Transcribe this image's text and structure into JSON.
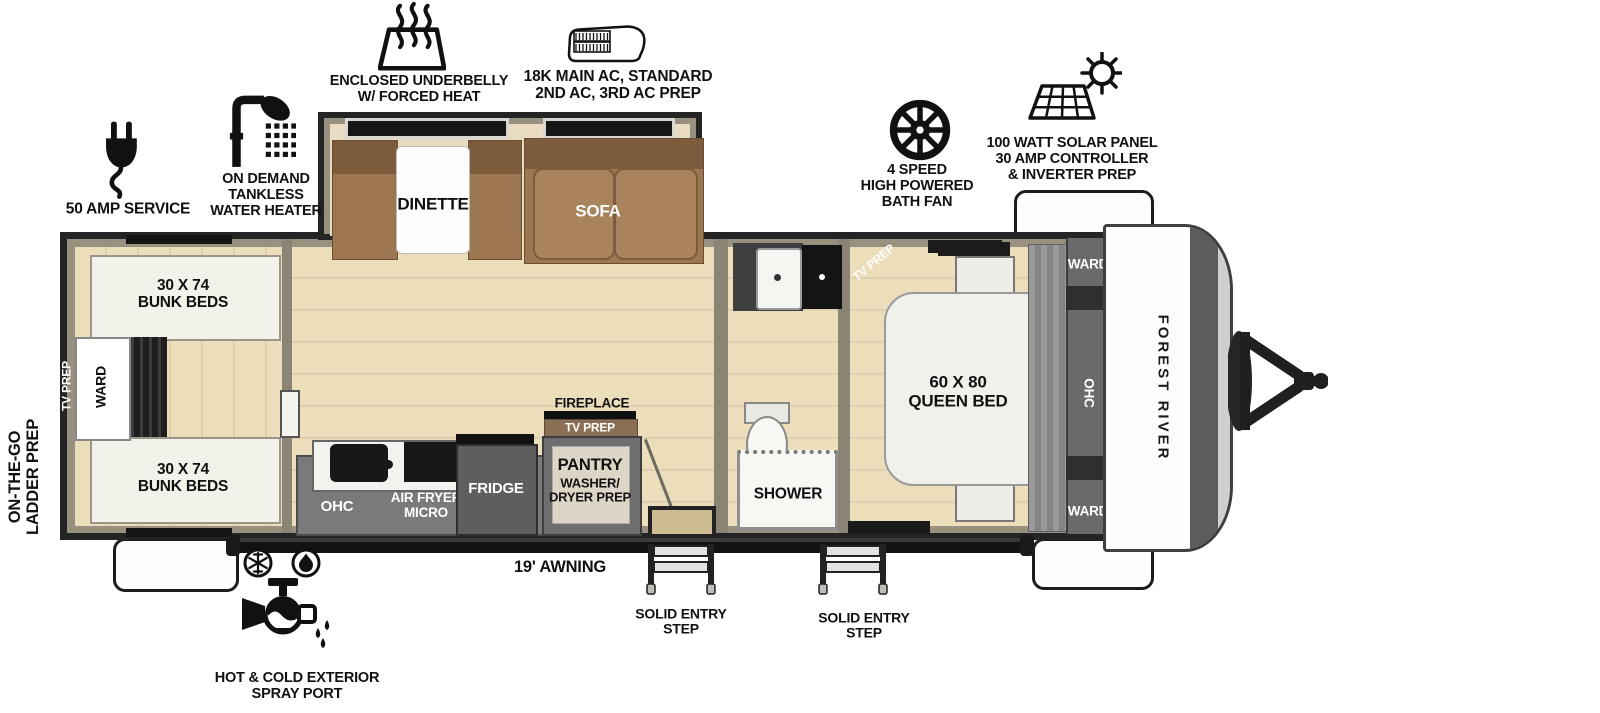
{
  "brand": "FOREST RIVER",
  "colors": {
    "outline": "#242424",
    "wall": "#99917f",
    "floor": "#ecddbb",
    "slide_floor": "#e9dcc2",
    "cabinet": "#7a7a7a",
    "sofa_brown": "#9c7751",
    "wood_trim": "#8a6f55"
  },
  "callouts": {
    "fifty_amp": "50 AMP SERVICE",
    "tankless": "ON DEMAND\nTANKLESS\nWATER HEATER",
    "underbelly": "ENCLOSED UNDERBELLY\nW/ FORCED HEAT",
    "main_ac": "18K MAIN AC, STANDARD\n2ND AC, 3RD AC PREP",
    "bath_fan": "4 SPEED\nHIGH POWERED\nBATH FAN",
    "solar": "100 WATT SOLAR PANEL\n30 AMP CONTROLLER\n& INVERTER PREP",
    "ladder_prep": "ON-THE-GO\nLADDER PREP",
    "awning": "19' AWNING",
    "entry_step_front": "SOLID ENTRY\nSTEP",
    "entry_step_rear": "SOLID ENTRY\nSTEP",
    "spray_port": "HOT & COLD EXTERIOR\nSPRAY PORT"
  },
  "interior": {
    "bunk_top": "30 X 74\nBUNK BEDS",
    "bunk_bottom": "30 X 74\nBUNK BEDS",
    "bunk_ward": "WARD",
    "bunk_tv_prep": "TV PREP",
    "dinette": "DINETTE",
    "sofa": "SOFA",
    "kitchen_ohc": "OHC",
    "air_fryer_micro": "AIR FRYER\nMICRO",
    "fridge": "FRIDGE",
    "pantry_title": "PANTRY",
    "pantry_sub": "WASHER/\nDRYER PREP",
    "fireplace": "FIREPLACE",
    "fireplace_tv_prep": "TV PREP",
    "shower": "SHOWER",
    "bedroom_tv_prep": "TV PREP",
    "queen_bed": "60 X 80\nQUEEN BED",
    "ward_top": "WARD",
    "bedroom_ohc": "OHC",
    "ward_bottom": "WARD"
  }
}
